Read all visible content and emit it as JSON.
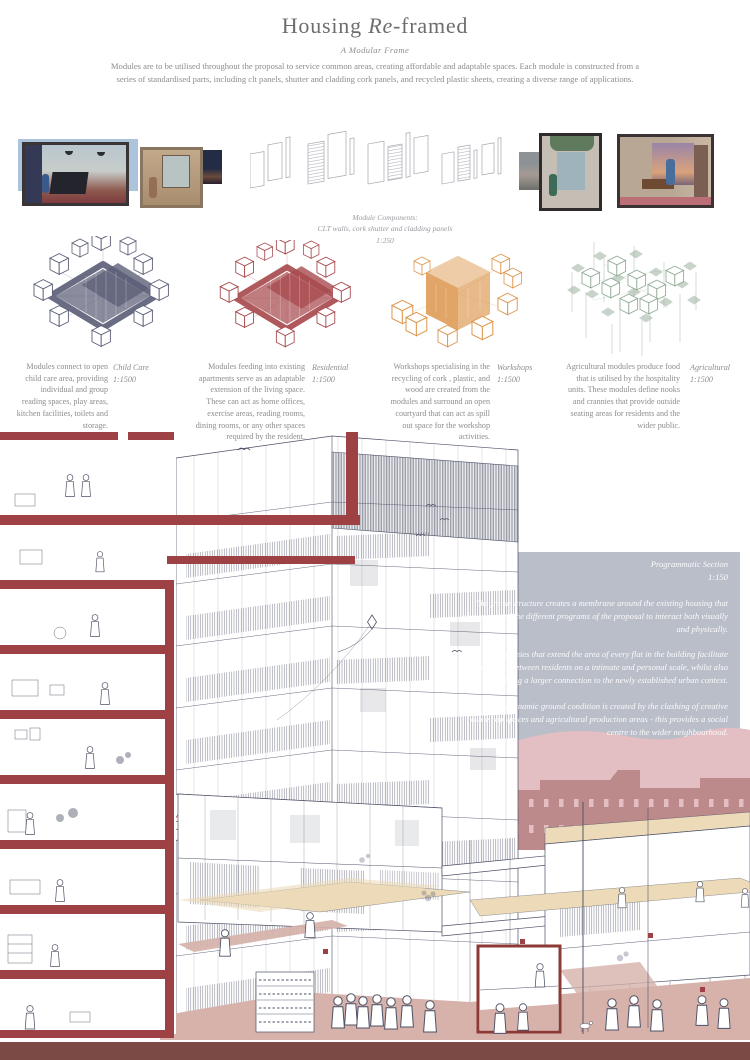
{
  "poster": {
    "title": {
      "pre": "Housing ",
      "italic": "Re",
      "post": "-framed"
    },
    "subtitle": "A Modular Frame",
    "intro": "Modules are to be utilised throughout the proposal to service common areas, creating affordable and adaptable spaces. Each module is constructed from a series of standardised parts, including clt panels, shutter and cladding cork panels, and recycled plastic sheets, creating a diverse range of applications."
  },
  "components_caption": {
    "line1": "Module Components:",
    "line2": "CLT walls, cork shutter and cladding panels",
    "line3": "1:250"
  },
  "modules": [
    {
      "label": "Child Care",
      "scale": "1:1500",
      "description": "Modules connect to open child care area, providing individual and group reading spaces, play areas, kitchen facilities, toilets and storage."
    },
    {
      "label": "Residential",
      "scale": "1:1500",
      "description": "Modules feeding into existing apartments serve as an adaptable extension of the living space. These can act as home offices, exercise areas, reading rooms, dining rooms, or any other spaces required by the resident."
    },
    {
      "label": "Workshops",
      "scale": "1:1500",
      "description": "Workshops specialising in the recycling of cork , plastic, and wood are created from the modules and surround an open courtyard that can act as spill out space for the workshop activities."
    },
    {
      "label": "Agricultural",
      "scale": "1:1500",
      "description": "Agricultural modules produce food that is utilised by the hospitality units. These modules define nooks and crannies that provide outside seating areas for residents and the wider public."
    }
  ],
  "section_panel": {
    "title": "Programmatic Section",
    "scale": "1:150",
    "para1": "The frame structure creates a membrane around the existing housing that allows each of the different programs of the proposal  to interact both visually and physically.",
    "para2": "The balconies that extend the area of every flat in the building facilitate meetings between residents on a intimate and personal scale, whilst also providing a larger connection to the newly established urban context.",
    "para3": "A diverse and dynamic ground condition is created by the clashing of creative workshop spaces and agricultural production areas  - this provides a social centre to the wider neighbourhood."
  },
  "colors": {
    "childcare": "#5d6078",
    "residential": "#a84b4f",
    "workshops": "#dd9a52",
    "agricultural": "#93ab97",
    "slab-red": "#9e4144",
    "frame-red": "#8c3a36",
    "panel-gray": "#b9bec8",
    "hill-pink": "#e3bec2",
    "city-rose": "#bd8a8b",
    "ground-pink": "#d6b2aa",
    "floor-beige": "#ecdab8",
    "ink": "#4d5166",
    "bottom-band": "#7c4a45",
    "text-gray": "#8d8d8d",
    "title-gray": "#6d6d6d"
  }
}
